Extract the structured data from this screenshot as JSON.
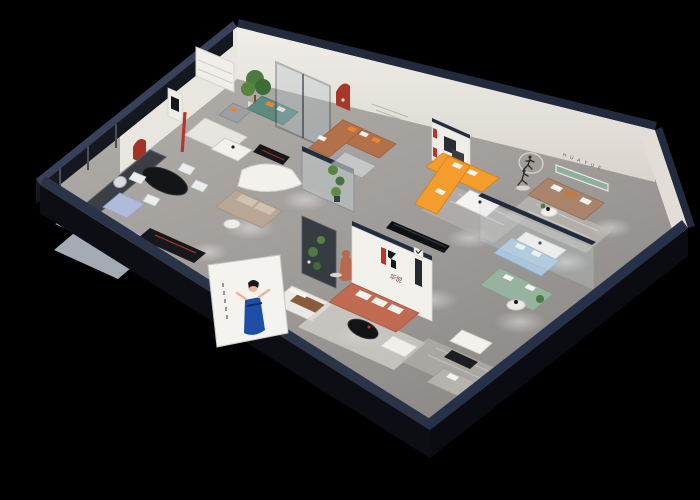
{
  "meta": {
    "kind": "isometric-3d-cutaway-render",
    "subject": "furniture showroom floor plan",
    "background": "#000000"
  },
  "brand": {
    "logo_glyph": "H",
    "logo_cn": "华悦",
    "wall_sign_letters": "H U A Y U E"
  },
  "palette": {
    "wall_top_navy": "#273049",
    "wall_white": "#eceae4",
    "floor_gray": "#a7a4a1",
    "accent_red": "#a83629",
    "logo_red": "#c03326",
    "logo_black": "#17171c",
    "sofa_orange": "#f59d2c",
    "sofa_caramel": "#b2714a",
    "sofa_terracotta": "#c06a52",
    "sofa_tan": "#a9846b",
    "sofa_teal": "#5e8a80",
    "sofa_sage": "#97b29f",
    "sofa_blue": "#a9c6dc",
    "sofa_lavender": "#b7c0dd",
    "plant_green": "#4c7a42",
    "sign_green": "#8fae9c",
    "poster_dress_blue": "#1d4fa6",
    "glass": "#cfe3e6"
  }
}
